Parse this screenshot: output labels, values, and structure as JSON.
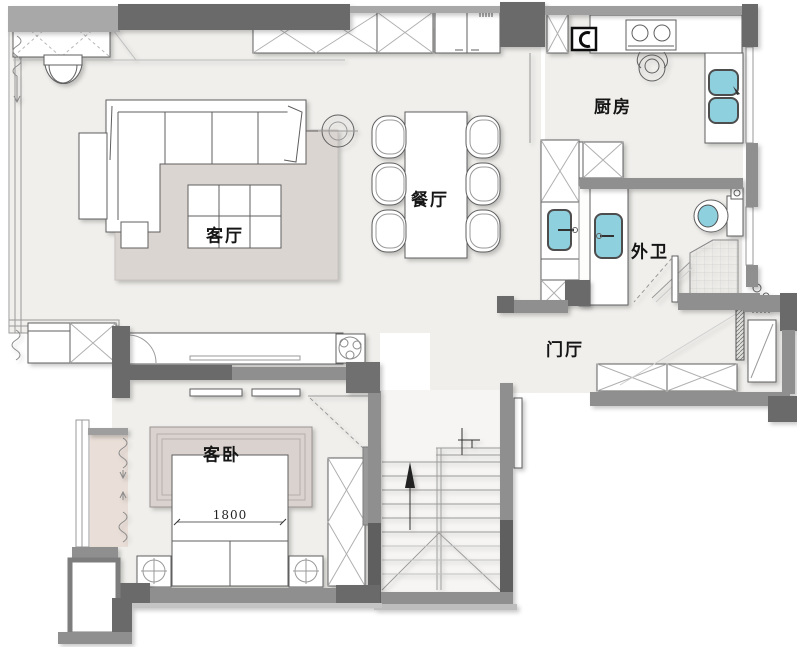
{
  "plan": {
    "type": "residential-floor-plan",
    "dimension_bed_width": "1800"
  },
  "rooms": {
    "living_room": {
      "label": "客厅"
    },
    "dining_room": {
      "label": "餐厅"
    },
    "kitchen": {
      "label": "厨房"
    },
    "bathroom": {
      "label": "外卫"
    },
    "foyer": {
      "label": "门厅"
    },
    "guest_bedroom": {
      "label": "客卧"
    }
  },
  "colors": {
    "floor": "#f0efec",
    "wall_mid": "#8f8f8f",
    "wall_dark": "#6b6b6b",
    "rug": "#dbd5d2",
    "headboard_panel": "#d9d2ce",
    "bay_window": "#eadfd8",
    "water_fixture_blue": "#8fd0df",
    "outline": "#5f5f5f"
  },
  "fixtures": [
    "sofa-icon",
    "side-table-icon",
    "ottoman-icon",
    "coffee-table-icon",
    "floor-lamp-icon",
    "armchair-icon",
    "rug",
    "dining-table-icon",
    "dining-chair-icon",
    "tv-console-icon",
    "plant-icon",
    "stove-icon",
    "cooking-pot-icon",
    "kitchen-sink-icon",
    "water-heater-icon",
    "wash-basin-icon",
    "vanity-sink-icon",
    "toilet-icon",
    "shower-icon",
    "shoe-cabinet-icon",
    "wardrobe-icon",
    "bed-icon",
    "nightstand-lamp-icon",
    "staircase",
    "up-arrow-icon",
    "entry-door-icon",
    "equipment-platform-icon",
    "curtain-icon",
    "storage-cabinet-icon"
  ]
}
